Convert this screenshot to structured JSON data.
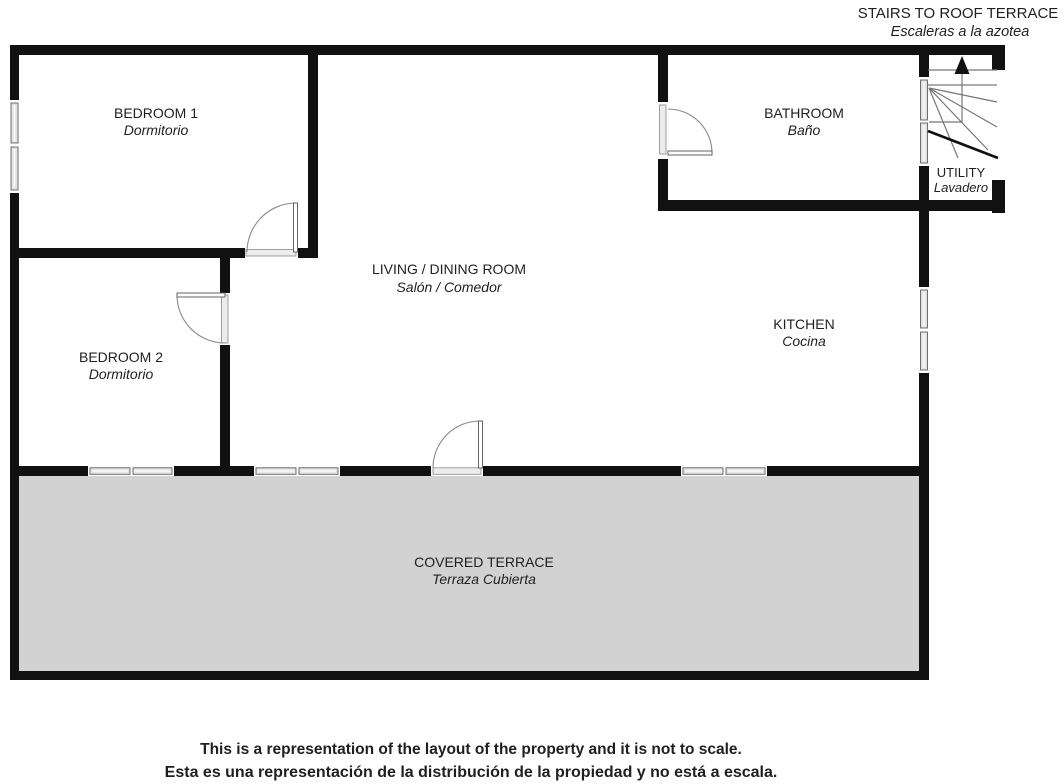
{
  "stairs_note": {
    "title": "STAIRS TO ROOF TERRACE",
    "subtitle": "Escaleras a la azotea"
  },
  "rooms": {
    "bedroom1": {
      "name": "BEDROOM 1",
      "name_es": "Dormitorio"
    },
    "bathroom": {
      "name": "BATHROOM",
      "name_es": "Baño"
    },
    "utility": {
      "name": "UTILITY",
      "name_es": "Lavadero"
    },
    "living_dining": {
      "name": "LIVING / DINING ROOM",
      "name_es": "Salón / Comedor"
    },
    "kitchen": {
      "name": "KITCHEN",
      "name_es": "Cocina"
    },
    "bedroom2": {
      "name": "BEDROOM 2",
      "name_es": "Dormitorio"
    },
    "covered_terrace": {
      "name": "COVERED TERRACE",
      "name_es": "Terraza Cubierta"
    }
  },
  "disclaimer": {
    "line_en": "This is a representation of the layout of the property and it is not to scale.",
    "line_es": "Esta es una representación de la distribución de la propiedad y no está a escala."
  },
  "colors": {
    "wall": "#111111",
    "terrace_fill": "#d2d2d2",
    "window_fill": "#e4e4e4",
    "disclaimer_en": "#1a1a1a",
    "disclaimer_es": "#e8121a",
    "label": "#1f1f1f"
  }
}
